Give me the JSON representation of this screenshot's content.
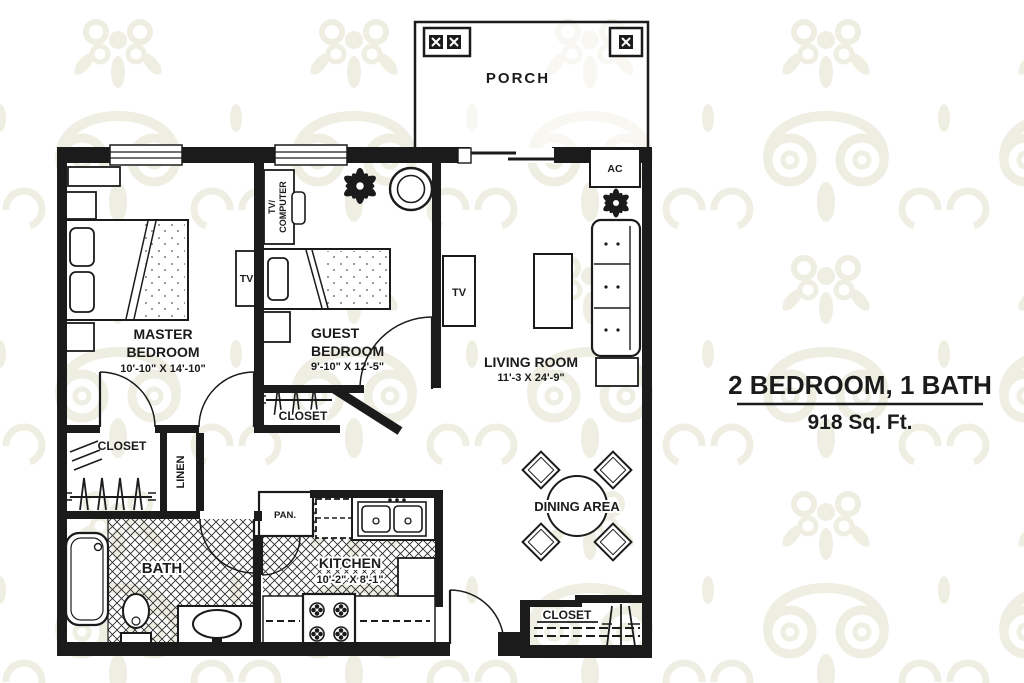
{
  "colors": {
    "ink": "#1b1b1b",
    "pattern": "#efeee2",
    "paper": "#ffffff"
  },
  "plan": {
    "porch": {
      "label": "PORCH"
    },
    "ac": {
      "label": "AC"
    },
    "master": {
      "line1": "MASTER",
      "line2": "BEDROOM",
      "dims": "10'-10\" X 14'-10\"",
      "tv": "TV"
    },
    "guest": {
      "line1": "GUEST",
      "line2": "BEDROOM",
      "dims": "9'-10\" X 12'-5\"",
      "desk1": "TV/",
      "desk2": "COMPUTER"
    },
    "living": {
      "label": "LIVING ROOM",
      "dims": "11'-3 X 24'-9\"",
      "tv": "TV"
    },
    "dining": {
      "label": "DINING AREA"
    },
    "kitchen": {
      "label": "KITCHEN",
      "dims": "10'-2\" X 8'-1\""
    },
    "pantry": {
      "label": "PAN."
    },
    "bath": {
      "label": "BATH"
    },
    "linen": {
      "label": "LINEN"
    },
    "master_closet": {
      "label": "CLOSET"
    },
    "guest_closet": {
      "label": "CLOSET"
    },
    "entry_closet": {
      "label": "CLOSET"
    }
  },
  "title_block": {
    "heading": "2 BEDROOM, 1 BATH",
    "area": "918 Sq. Ft."
  }
}
